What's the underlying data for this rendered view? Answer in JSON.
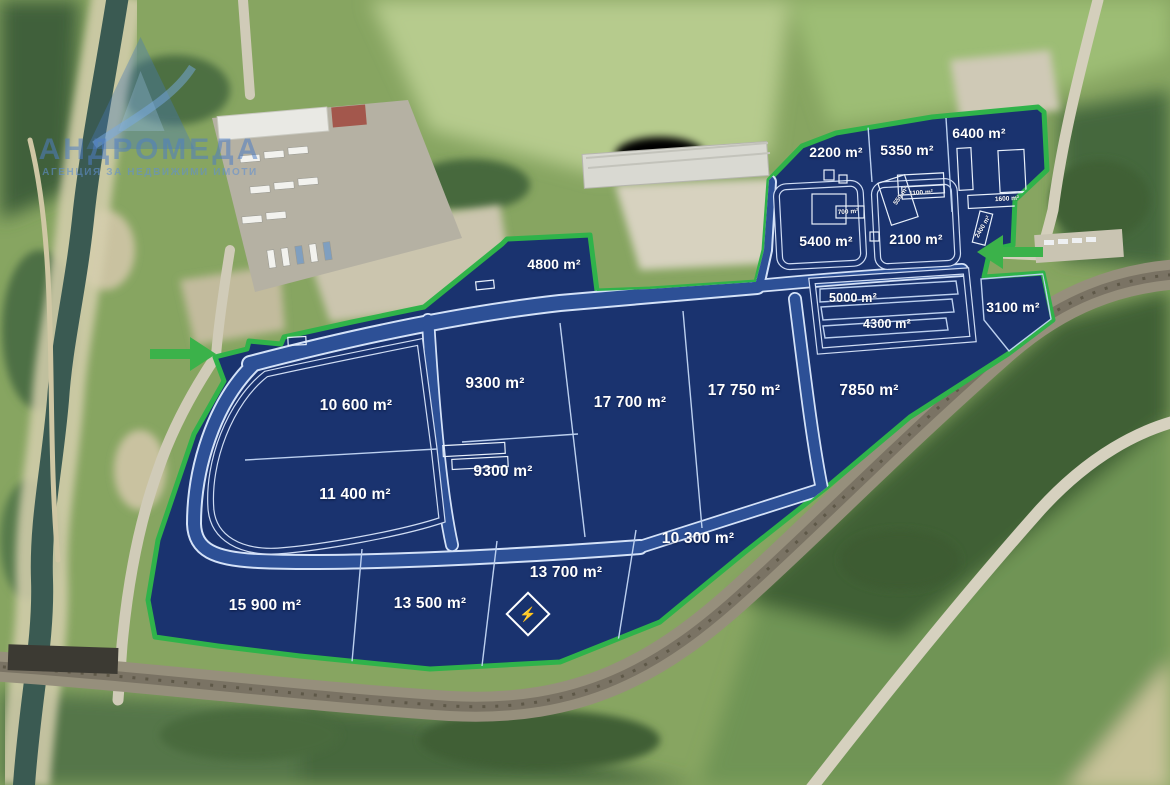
{
  "watermark": {
    "brand": "АНДРОМЕДА",
    "tagline": "АГЕНЦИЯ ЗА НЕДВИЖИМИ ИМОТИ"
  },
  "colors": {
    "plot_fill": "#1a336f",
    "road_blue": "#2d5096",
    "line_light": "#cfdcf3",
    "boundary_green": "#2fb34a",
    "arrow_green": "#3bb24a",
    "label_white": "#ffffff"
  },
  "plots": [
    {
      "id": "2200",
      "label": "2200 m²",
      "x": 836,
      "y": 152,
      "size": "md"
    },
    {
      "id": "5350",
      "label": "5350 m²",
      "x": 907,
      "y": 150,
      "size": "md"
    },
    {
      "id": "6400",
      "label": "6400 m²",
      "x": 979,
      "y": 133,
      "size": "md"
    },
    {
      "id": "5400",
      "label": "5400 m²",
      "x": 826,
      "y": 241,
      "size": "md"
    },
    {
      "id": "2100",
      "label": "2100 m²",
      "x": 916,
      "y": 239,
      "size": "md"
    },
    {
      "id": "4800",
      "label": "4800 m²",
      "x": 554,
      "y": 264,
      "size": "md"
    },
    {
      "id": "5000",
      "label": "5000 m²",
      "x": 853,
      "y": 298,
      "size": "sm"
    },
    {
      "id": "4300",
      "label": "4300 m²",
      "x": 887,
      "y": 324,
      "size": "sm"
    },
    {
      "id": "3100",
      "label": "3100 m²",
      "x": 1013,
      "y": 307,
      "size": "md"
    },
    {
      "id": "9300a",
      "label": "9300 m²",
      "x": 495,
      "y": 384,
      "size": "lg"
    },
    {
      "id": "17700",
      "label": "17 700 m²",
      "x": 630,
      "y": 403,
      "size": "lg"
    },
    {
      "id": "17750",
      "label": "17 750 m²",
      "x": 744,
      "y": 391,
      "size": "lg"
    },
    {
      "id": "7850",
      "label": "7850 m²",
      "x": 869,
      "y": 391,
      "size": "lg"
    },
    {
      "id": "10600",
      "label": "10 600 m²",
      "x": 356,
      "y": 406,
      "size": "lg"
    },
    {
      "id": "9300b",
      "label": "9300 m²",
      "x": 503,
      "y": 472,
      "size": "lg"
    },
    {
      "id": "11400",
      "label": "11 400 m²",
      "x": 355,
      "y": 495,
      "size": "lg"
    },
    {
      "id": "10300",
      "label": "10 300 m²",
      "x": 698,
      "y": 539,
      "size": "lg"
    },
    {
      "id": "13700",
      "label": "13 700 m²",
      "x": 566,
      "y": 573,
      "size": "lg"
    },
    {
      "id": "13500",
      "label": "13 500 m²",
      "x": 430,
      "y": 604,
      "size": "lg"
    },
    {
      "id": "15900",
      "label": "15 900 m²",
      "x": 265,
      "y": 606,
      "size": "lg"
    }
  ],
  "building_labels": [
    {
      "id": "b700",
      "label": "700 m²",
      "x": 848,
      "y": 212,
      "rot": -4
    },
    {
      "id": "b1100",
      "label": "1100 m²",
      "x": 921,
      "y": 193,
      "rot": -4
    },
    {
      "id": "b550",
      "label": "550 m²",
      "x": 901,
      "y": 196,
      "rot": -55
    },
    {
      "id": "b1600",
      "label": "1600 m²",
      "x": 1007,
      "y": 199,
      "rot": -3
    },
    {
      "id": "b2400",
      "label": "2400 m²",
      "x": 983,
      "y": 227,
      "rot": -60
    }
  ],
  "entrance_arrows": [
    {
      "id": "entrance-west",
      "direction": "right",
      "x": 184,
      "y": 354
    },
    {
      "id": "entrance-northeast",
      "direction": "left",
      "x": 1009,
      "y": 252
    }
  ],
  "power_marker": {
    "symbol": "⚡",
    "x": 528,
    "y": 614
  }
}
